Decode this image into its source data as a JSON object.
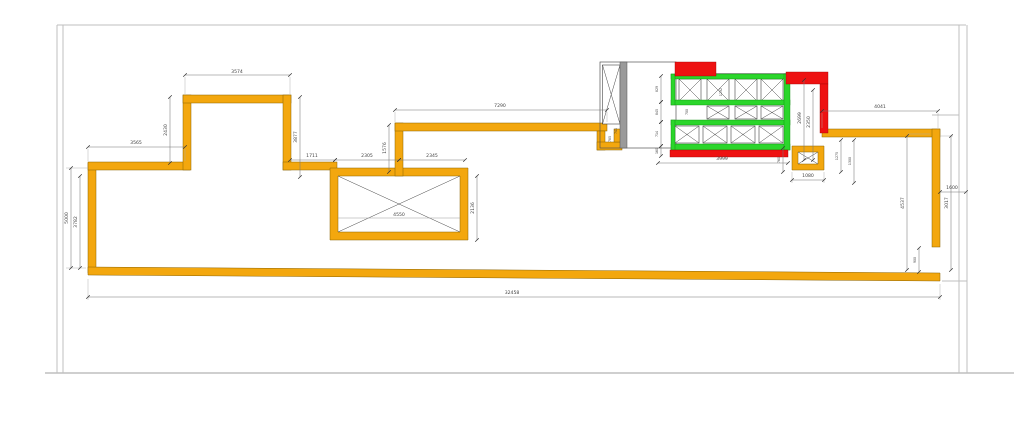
{
  "drawing": {
    "type": "architectural floor plan (CAD slab/wall layout)",
    "colors": {
      "background": "#FFFFFF",
      "wall_orange": "#F3A70E",
      "highlight_red": "#EE1111",
      "beam_green": "#2BD62B",
      "wall_gray": "#9A9A9A",
      "frame_gray": "#BFBFBF"
    },
    "dimensions": {
      "d3574": "3574",
      "d2430": "2430",
      "d3565": "3565",
      "d3877": "3877",
      "d1711": "1711",
      "d2305": "2305",
      "d2345": "2345",
      "d7290": "7290",
      "d1576": "1576",
      "d2136": "2136",
      "d4550": "4550",
      "d5000": "5000",
      "d3782": "3782",
      "d32458": "32458",
      "d4041": "4041",
      "d2699": "2699",
      "d2350": "2350",
      "d829": "829",
      "d845": "845",
      "d714": "714",
      "d160": "160",
      "d3999": "3999",
      "d760": "760",
      "d1080": "1080",
      "d1275": "1275",
      "d1300": "1300",
      "d4537": "4537",
      "d3017": "3017",
      "d1600": "1600",
      "d900": "900",
      "d741": "741",
      "d785": "785",
      "d700": "700",
      "d1292": "1292"
    }
  }
}
